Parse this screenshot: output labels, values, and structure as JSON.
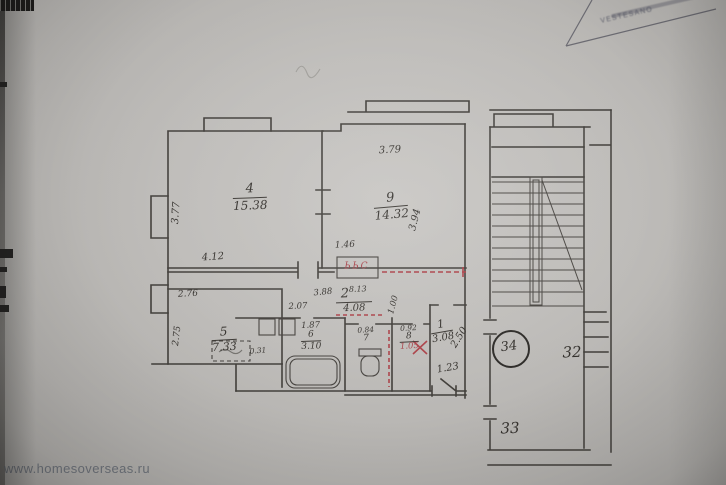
{
  "watermark": "www.homesoverseas.ru",
  "stamp": {
    "text": "VESTESANO"
  },
  "plan": {
    "room4": {
      "number": "4",
      "area": "15.38",
      "dim_left": "3.77",
      "dim_bottom": "4.12"
    },
    "room9": {
      "number": "9",
      "area": "14.32",
      "dim_top": "3.79",
      "dim_right": "3.94"
    },
    "room5": {
      "number": "5",
      "area": "7.33",
      "dim_top": "2.76",
      "dim_left": "2.75"
    },
    "room2": {
      "number": "2",
      "area": "8.13",
      "dim_bottom": "4.08",
      "dim_left": "2.07",
      "dim_top": "3.88",
      "dim_door": "1.00"
    },
    "room6": {
      "number": "6",
      "area": "3.10",
      "dim_top": "1.87"
    },
    "room7": {
      "number": "7",
      "dim_top": "0.84"
    },
    "room8": {
      "number": "8",
      "dim_top": "0.92",
      "dim_bottom": "1.05"
    },
    "room1": {
      "number": "1",
      "area": "3.08",
      "dim_diag": "2.50",
      "dim_bottom": "1.23"
    },
    "closet_dim": "1.46",
    "closet_mark": "ЬЬС",
    "dim_small": "0.31",
    "apartment_number": "34",
    "apt_32": "32",
    "apt_33": "33"
  }
}
